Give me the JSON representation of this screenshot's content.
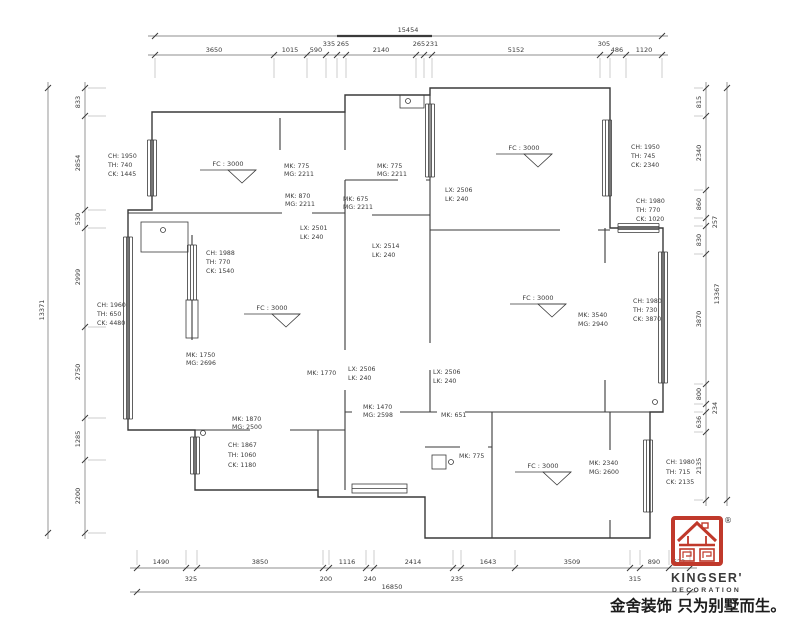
{
  "title_block": {
    "brand": "KINGSER'",
    "brand_sub": "DECORATION",
    "registered": "®",
    "slogan": "金舍装饰 只为别墅而生。"
  },
  "colors": {
    "logo_red": "#c0392b",
    "line": "#3a3a3a"
  },
  "dimensions": {
    "top": {
      "overall": "15454",
      "segments": [
        "3650",
        "1015",
        "590",
        "335",
        "265",
        "2140",
        "265",
        "231",
        "5152",
        "305",
        "486",
        "1120"
      ]
    },
    "bottom": {
      "overall": "16850",
      "segments_large": [
        "1490",
        "3850",
        "1116",
        "2414",
        "1643",
        "3509",
        "890",
        "623"
      ],
      "segments_small": [
        "325",
        "200",
        "240",
        "235",
        "315"
      ]
    },
    "left": {
      "overall": "13371",
      "segments": [
        "833",
        "2854",
        "530",
        "2999",
        "2750",
        "1285",
        "2200"
      ]
    },
    "right": {
      "overall": "13367",
      "segments": [
        "815",
        "2340",
        "860",
        "257",
        "830",
        "3870",
        "800",
        "234",
        "636",
        "2135"
      ]
    }
  },
  "windows": {
    "bedroom1_west": [
      "CH: 1950",
      "TH: 740",
      "CK: 1445"
    ],
    "master_west": [
      "CH: 1960",
      "TH: 650",
      "CK: 4480"
    ],
    "master_inner": [
      "CH: 1988",
      "TH: 770",
      "CK: 1540"
    ],
    "bedroom2_east": [
      "CH: 1950",
      "TH: 745",
      "CK: 2340"
    ],
    "bedroom2_south": [
      "CH: 1980",
      "TH: 770",
      "CK: 1020"
    ],
    "living_east": [
      "CH: 1980",
      "TH: 730",
      "CK: 3870"
    ],
    "bath_west": [
      "CH: 1867",
      "TH: 1060",
      "CK: 1180"
    ],
    "bedroom3_east": [
      "CH: 1980",
      "TH: 715",
      "CK: 2135"
    ]
  },
  "doors": {
    "d1": [
      "MK: 775",
      "MG: 2211"
    ],
    "d2": [
      "MK: 775",
      "MG: 2211"
    ],
    "d3": [
      "MK: 870",
      "MG: 2211"
    ],
    "d4": [
      "MK: 675",
      "MG: 2211"
    ],
    "d5": [
      "MK: 1750",
      "MG: 2696"
    ],
    "d6": [
      "MK: 1770"
    ],
    "d7": [
      "MK: 1870",
      "MG: 2500"
    ],
    "d8": [
      "MK: 1470",
      "MG: 2598"
    ],
    "d9": [
      "MK: 651"
    ],
    "d10": [
      "MK: 775"
    ],
    "d11": [
      "MK: 3540",
      "MG: 2940"
    ],
    "d12": [
      "MK: 2340",
      "MG: 2600"
    ]
  },
  "beams": {
    "b1": [
      "LX: 2501",
      "LK: 240"
    ],
    "b2": [
      "LX: 2506",
      "LK: 240"
    ],
    "b3": [
      "LX: 2514",
      "LK: 240"
    ],
    "b4": [
      "LX: 2506",
      "LK: 240"
    ],
    "b5": [
      "LX: 2506",
      "LK: 240"
    ]
  },
  "ceiling_markers": [
    "FC : 3000",
    "FC : 3000",
    "FC : 3000",
    "FC : 3000",
    "FC : 3000"
  ]
}
